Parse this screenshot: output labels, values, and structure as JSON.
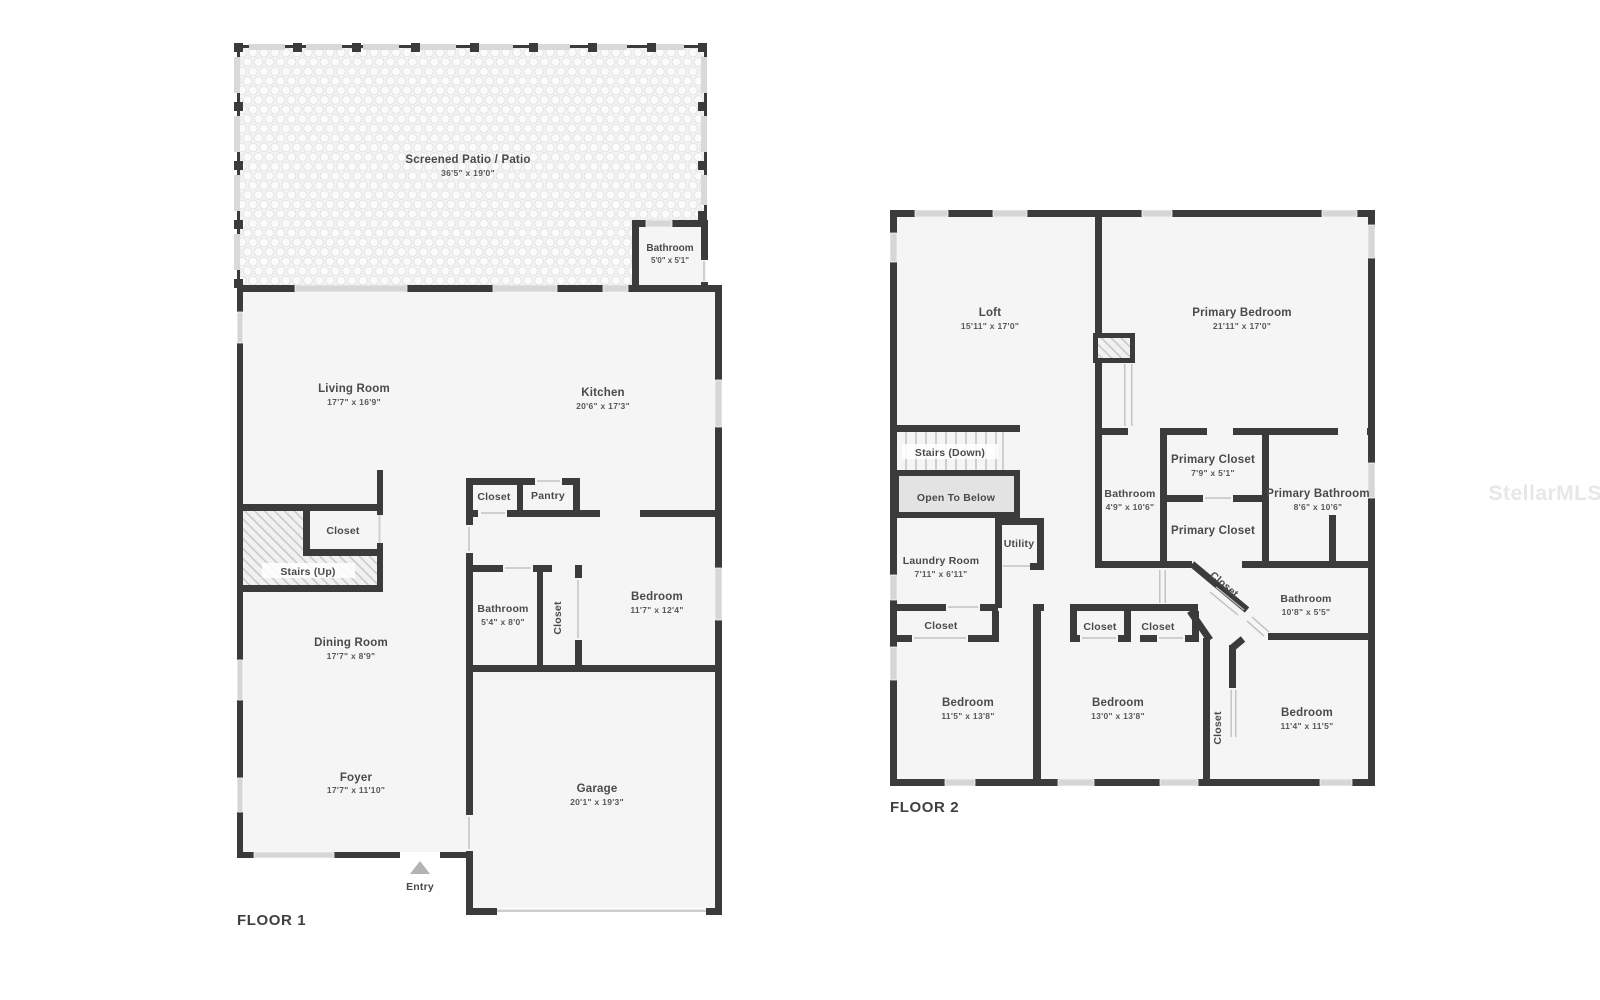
{
  "watermark": "StellarMLS",
  "colors": {
    "wall": "#3b3b3b",
    "room_fill": "#f5f5f5",
    "label_text": "#4a4a4a"
  },
  "floor1": {
    "title": "FLOOR 1",
    "entry_label": "Entry",
    "rooms": {
      "patio": {
        "name": "Screened Patio / Patio",
        "dims": "36'5\" x 19'0\""
      },
      "patio_bathroom": {
        "name": "Bathroom",
        "dims": "5'0\" x 5'1\""
      },
      "living_room": {
        "name": "Living Room",
        "dims": "17'7\" x 16'9\""
      },
      "kitchen": {
        "name": "Kitchen",
        "dims": "20'6\" x 17'3\""
      },
      "hall_closet": {
        "name": "Closet"
      },
      "pantry": {
        "name": "Pantry"
      },
      "stair_closet": {
        "name": "Closet"
      },
      "stairs": {
        "name": "Stairs (Up)"
      },
      "dining_room": {
        "name": "Dining Room",
        "dims": "17'7\" x 8'9\""
      },
      "bathroom": {
        "name": "Bathroom",
        "dims": "5'4\" x 8'0\""
      },
      "bedroom_closet": {
        "name": "Closet"
      },
      "bedroom": {
        "name": "Bedroom",
        "dims": "11'7\" x 12'4\""
      },
      "foyer": {
        "name": "Foyer",
        "dims": "17'7\" x 11'10\""
      },
      "garage": {
        "name": "Garage",
        "dims": "20'1\" x 19'3\""
      }
    }
  },
  "floor2": {
    "title": "FLOOR 2",
    "rooms": {
      "loft": {
        "name": "Loft",
        "dims": "15'11\" x 17'0\""
      },
      "primary_bedroom": {
        "name": "Primary Bedroom",
        "dims": "21'11\" x 17'0\""
      },
      "stairs_down": {
        "name": "Stairs (Down)"
      },
      "open_to_below": {
        "name": "Open To Below"
      },
      "laundry_room": {
        "name": "Laundry Room",
        "dims": "7'11\" x 6'11\""
      },
      "utility": {
        "name": "Utility"
      },
      "bathroom_mid": {
        "name": "Bathroom",
        "dims": "4'9\" x 10'6\""
      },
      "primary_closet_upper": {
        "name": "Primary Closet",
        "dims": "7'9\" x 5'1\""
      },
      "primary_closet_lower": {
        "name": "Primary Closet"
      },
      "primary_bathroom": {
        "name": "Primary Bathroom",
        "dims": "8'6\" x 10'6\""
      },
      "diag_closet": {
        "name": "Closet"
      },
      "bathroom_right": {
        "name": "Bathroom",
        "dims": "10'8\" x 5'5\""
      },
      "bedroom1_closet": {
        "name": "Closet"
      },
      "bedroom2_closet_a": {
        "name": "Closet"
      },
      "bedroom2_closet_b": {
        "name": "Closet"
      },
      "bedroom3_closet": {
        "name": "Closet"
      },
      "bedroom1": {
        "name": "Bedroom",
        "dims": "11'5\" x 13'8\""
      },
      "bedroom2": {
        "name": "Bedroom",
        "dims": "13'0\" x 13'8\""
      },
      "bedroom3": {
        "name": "Bedroom",
        "dims": "11'4\" x 11'5\""
      }
    }
  }
}
